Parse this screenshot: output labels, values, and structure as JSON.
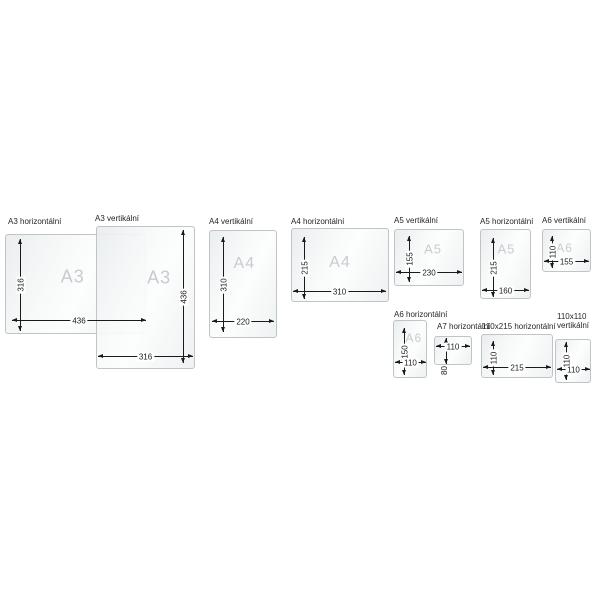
{
  "style": {
    "background": "#ffffff",
    "sheet_border": "#bfc4c6",
    "sheet_fill": "#f3f5f6",
    "letter_color": "#c6ccd1",
    "dimension_color": "#1a1a1a",
    "label_color": "#262626"
  },
  "panels": [
    {
      "id": "a3-horizontal",
      "label": "A3 horizontální",
      "letter": "A3",
      "width_value": "436",
      "height_value": "316"
    },
    {
      "id": "a3-vertical",
      "label": "A3 vertikální",
      "letter": "A3",
      "width_value": "316",
      "height_value": "436"
    },
    {
      "id": "a4-vertical",
      "label": "A4 vertikální",
      "letter": "A4",
      "width_value": "220",
      "height_value": "310"
    },
    {
      "id": "a4-horizontal",
      "label": "A4 horizontální",
      "letter": "A4",
      "width_value": "310",
      "height_value": "215"
    },
    {
      "id": "a5-vertical",
      "label": "A5 vertikální",
      "letter": "A5",
      "width_value": "230",
      "height_value": "155"
    },
    {
      "id": "a5-horizontal",
      "label": "A5 horizontální",
      "letter": "A5",
      "width_value": "160",
      "height_value": "215"
    },
    {
      "id": "a6-vertical",
      "label": "A6 vertikální",
      "letter": "A6",
      "width_value": "155",
      "height_value": "110"
    },
    {
      "id": "a6-horizontal",
      "label": "A6 horizontální",
      "letter": "A6",
      "width_value": "110",
      "height_value": "150"
    },
    {
      "id": "a7-horizontal",
      "label": "A7 horizontální",
      "letter": "",
      "width_value": "110",
      "height_value": "80"
    },
    {
      "id": "110x215-horizontal",
      "label": "110x215 horizontální",
      "letter": "",
      "width_value": "215",
      "height_value": "110"
    },
    {
      "id": "110x110-vertical",
      "label": "110x110\nvertikální",
      "letter": "",
      "width_value": "110",
      "height_value": "110"
    }
  ]
}
